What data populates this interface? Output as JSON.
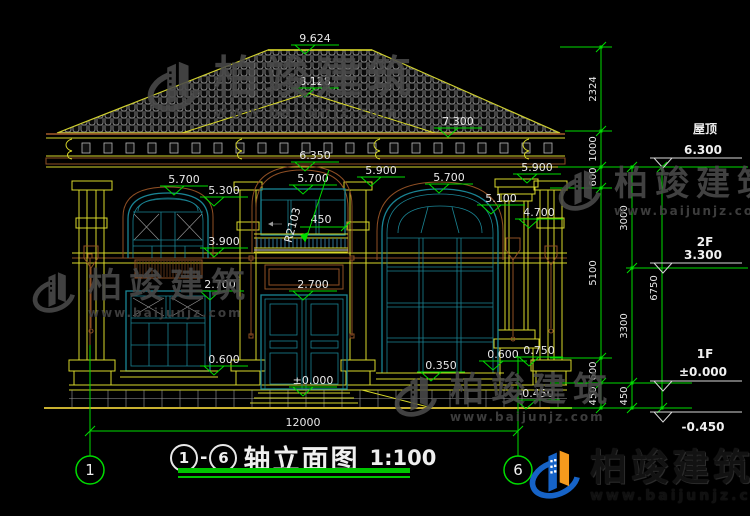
{
  "drawing": {
    "title": {
      "axis_start": "1",
      "axis_end": "6",
      "dash": "-",
      "name": "轴立面图",
      "scale": "1:100"
    },
    "overall_width_dim": "12000",
    "axis_bubbles": [
      {
        "label": "1",
        "x": 90
      },
      {
        "label": "6",
        "x": 518
      }
    ],
    "levels": [
      {
        "label": "9.624",
        "x": 315,
        "y": 45
      },
      {
        "label": "8.128",
        "x": 315,
        "y": 88
      },
      {
        "label": "7.300",
        "x": 458,
        "y": 128
      },
      {
        "label": "6.350",
        "x": 315,
        "y": 162
      },
      {
        "label": "5.900",
        "x": 381,
        "y": 177
      },
      {
        "label": "5.900",
        "x": 537,
        "y": 174
      },
      {
        "label": "5.700",
        "x": 184,
        "y": 186
      },
      {
        "label": "5.700",
        "x": 313,
        "y": 185
      },
      {
        "label": "5.700",
        "x": 449,
        "y": 184
      },
      {
        "label": "5.300",
        "x": 224,
        "y": 197
      },
      {
        "label": "5.100",
        "x": 501,
        "y": 205
      },
      {
        "label": "4.700",
        "x": 539,
        "y": 219
      },
      {
        "label": "3.900",
        "x": 224,
        "y": 248
      },
      {
        "label": "2.700",
        "x": 220,
        "y": 291
      },
      {
        "label": "2.700",
        "x": 313,
        "y": 291
      },
      {
        "label": "0.600",
        "x": 224,
        "y": 366
      },
      {
        "label": "0.600",
        "x": 503,
        "y": 361
      },
      {
        "label": "0.750",
        "x": 539,
        "y": 357
      },
      {
        "label": "0.350",
        "x": 441,
        "y": 372
      },
      {
        "label": "±0.000",
        "x": 313,
        "y": 387
      },
      {
        "label": "-0.450",
        "x": 536,
        "y": 400
      }
    ],
    "chains": [
      {
        "x": 601,
        "ticks": [
          47,
          131,
          167,
          188,
          358,
          383,
          408
        ],
        "labels": [
          {
            "t": "2324",
            "y": 89
          },
          {
            "t": "1000",
            "y": 149
          },
          {
            "t": "600",
            "y": 177
          },
          {
            "t": "5100",
            "y": 273
          },
          {
            "t": "600",
            "y": 371
          },
          {
            "t": "450",
            "y": 396
          }
        ]
      },
      {
        "x": 632,
        "ticks": [
          167,
          268,
          383,
          408
        ],
        "labels": [
          {
            "t": "3000",
            "y": 218
          },
          {
            "t": "3300",
            "y": 326
          },
          {
            "t": "450",
            "y": 396
          }
        ]
      },
      {
        "x": 662,
        "ticks": [
          167,
          408
        ],
        "labels": [
          {
            "t": "6750",
            "y": 288
          }
        ]
      }
    ],
    "right_levels": [
      {
        "name": "屋顶",
        "elev": "6.300",
        "y": 158,
        "ndy": -25,
        "edy": -4
      },
      {
        "name": "2F",
        "elev": "3.300",
        "y": 263,
        "ndy": -17,
        "edy": -4
      },
      {
        "name": "1F",
        "elev": "±0.000",
        "y": 381,
        "ndy": -23,
        "edy": -5
      },
      {
        "name": "",
        "elev": "-0.450",
        "y": 412,
        "ndy": 0,
        "edy": 19
      }
    ],
    "misc": {
      "railing_dim": "450",
      "radius_callout": "R2103"
    }
  },
  "watermark": {
    "brand": "柏竣建筑",
    "url": "www.baijunjz.com",
    "positions": [
      {
        "x": 142,
        "y": 54,
        "brand_px": 44,
        "url_px": 15,
        "glyph": 64
      },
      {
        "x": 554,
        "y": 164,
        "brand_px": 34,
        "url_px": 12,
        "glyph": 52
      },
      {
        "x": 28,
        "y": 266,
        "brand_px": 34,
        "url_px": 12,
        "glyph": 52
      },
      {
        "x": 390,
        "y": 370,
        "brand_px": 34,
        "url_px": 12,
        "glyph": 52
      }
    ]
  },
  "logo": {
    "brand": "柏竣建筑",
    "url": "www.baijunjz.com"
  },
  "colors": {
    "dim_green": "#00dc00",
    "cad_yellow": "#d8d82a",
    "cad_brown": "#8f4f24",
    "window_teal": "#1a8494",
    "logo_blue": "#1663c7",
    "logo_orange": "#f59a1d"
  }
}
